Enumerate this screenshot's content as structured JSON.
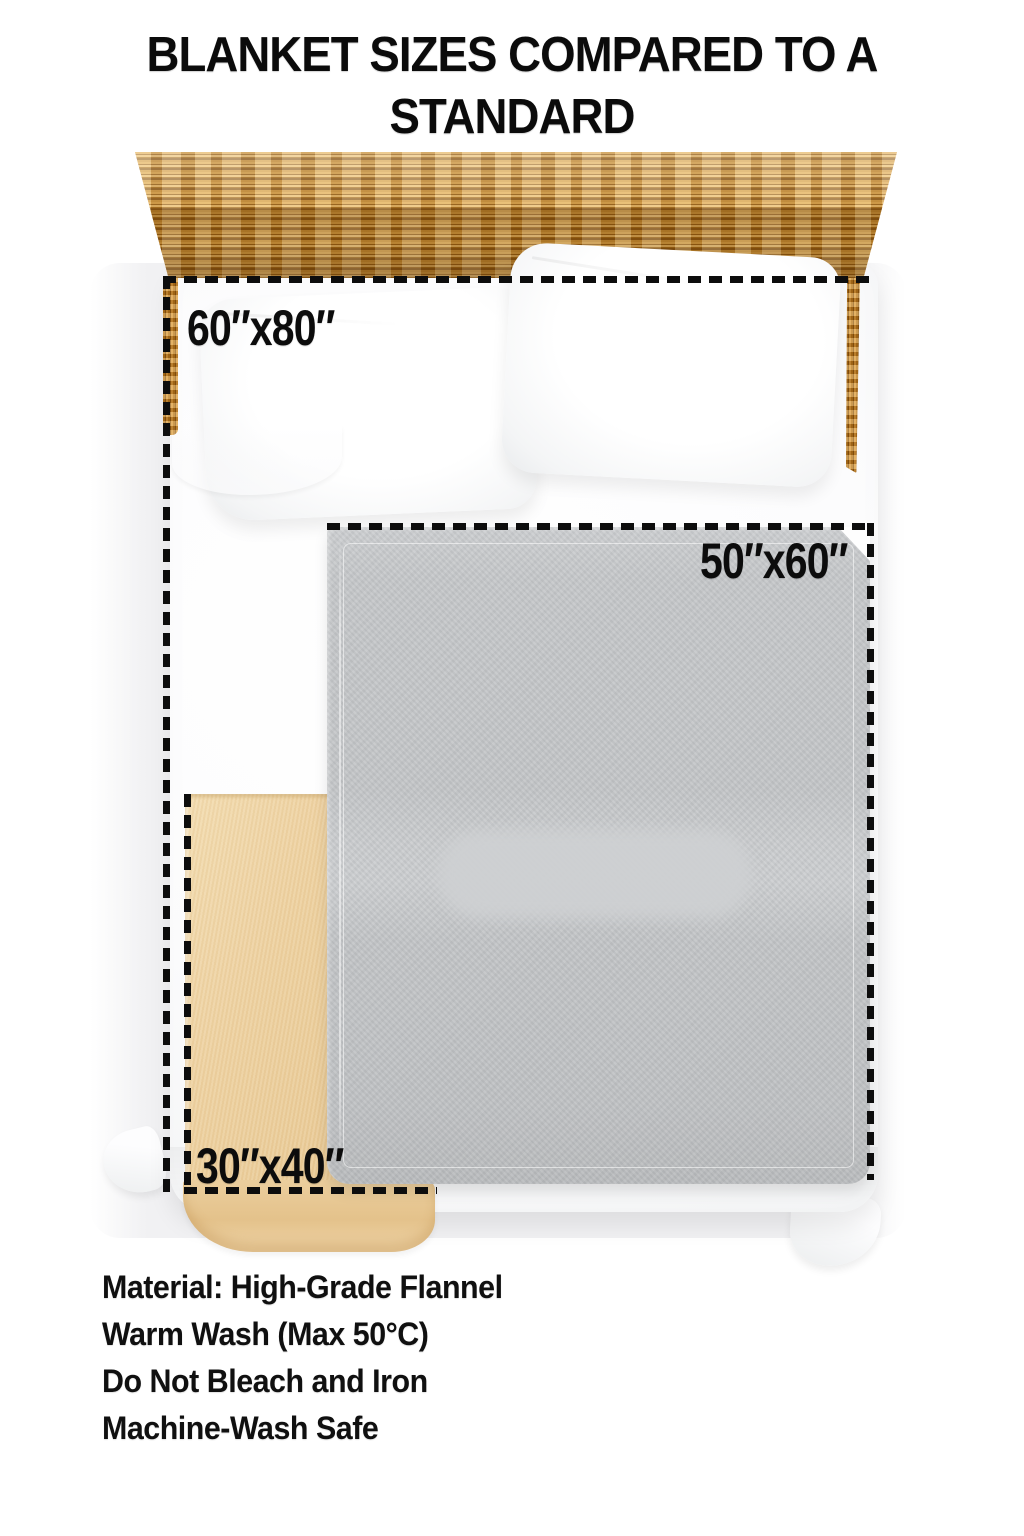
{
  "title": {
    "line1": "BLANKET SIZES COMPARED TO A STANDARD",
    "line2": "QUEEN SIZE BED"
  },
  "comparison": {
    "bed_type": "Standard Queen Size Bed",
    "blankets": [
      {
        "id": "large",
        "size_label": "60″x80″"
      },
      {
        "id": "medium",
        "size_label": "50″x60″"
      },
      {
        "id": "small",
        "size_label": "30″x40″"
      }
    ]
  },
  "care_instructions": [
    "Material: High-Grade Flannel",
    "Warm Wash (Max 50°C)",
    "Do Not Bleach and Iron",
    "Machine-Wash Safe"
  ],
  "colors": {
    "label_text": "#0c0c0c",
    "dash_outline": "#0d0d0d",
    "headboard_wood": "#b5741c",
    "gray_blanket": "#c5c7c9",
    "tan_blanket": "#eed2a2",
    "bedding_white": "#fdfdfe",
    "backdrop_gray": "#f1f1f3"
  }
}
